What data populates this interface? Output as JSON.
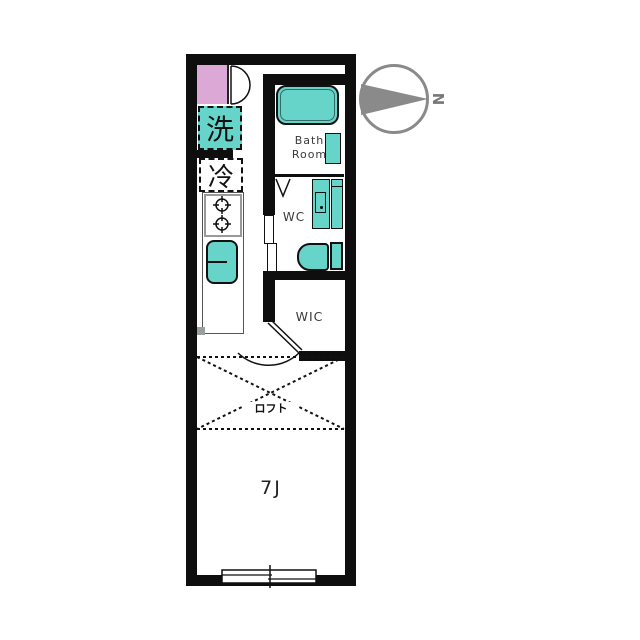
{
  "plan": {
    "type": "apartment-floor-plan",
    "compass": {
      "north_label": "N",
      "direction": "north-points-right"
    },
    "rooms": {
      "kitchen_hall": {
        "washing_machine_label": "洗",
        "refrigerator_label": "冷"
      },
      "bathroom": {
        "label": "Bath\nRoom"
      },
      "toilet_room": {
        "label": "WC"
      },
      "walk_in_closet": {
        "label": "WIC"
      },
      "loft": {
        "label": "ロフト"
      },
      "main_room": {
        "label": "7J"
      }
    },
    "fixtures": [
      "entrance-step",
      "entrance-door",
      "washing-machine-space",
      "refrigerator-space",
      "two-burner-stove",
      "kitchen-sink",
      "kitchen-counter",
      "bathtub",
      "bath-stool-counter",
      "bath-folding-door",
      "washbasin-vanity",
      "toilet",
      "wc-sliding-door",
      "room-swing-door",
      "loft-area-dashed",
      "sliding-window"
    ],
    "colors": {
      "fixture_teal": "#67d4ca",
      "entrance_pink": "#dca8d6",
      "wall_black": "#0e0e0e",
      "compass_gray": "#8a8a8a",
      "line_black": "#111111"
    }
  }
}
